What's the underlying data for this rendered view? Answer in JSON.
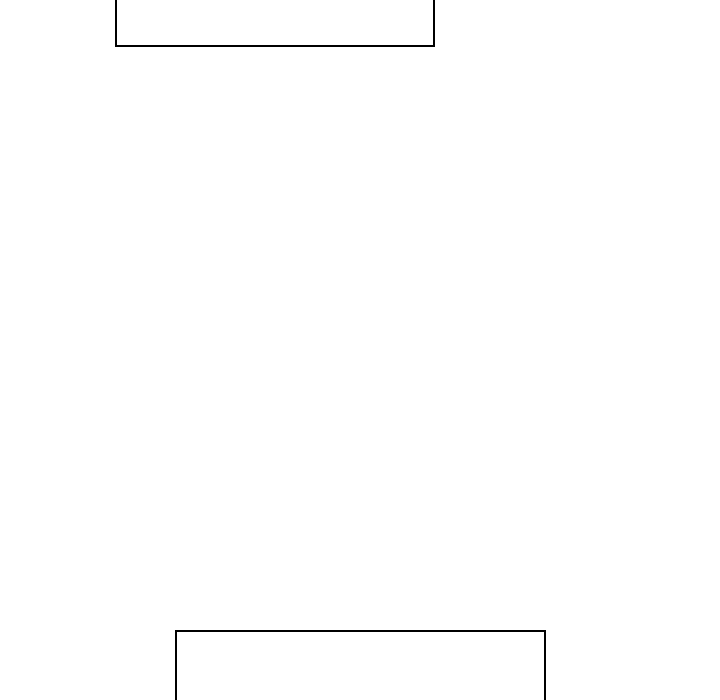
{
  "canvas": {
    "background_color": "#ffffff",
    "width_px": 720,
    "height_px": 700
  },
  "panels": [
    {
      "id": "top-panel",
      "description": "empty rectangular box clipped by the top edge of the screen",
      "border_color": "#000000",
      "fill_color": "#ffffff",
      "content": ""
    },
    {
      "id": "bottom-panel",
      "description": "empty rectangular box clipped by the bottom edge of the screen",
      "border_color": "#000000",
      "fill_color": "#ffffff",
      "content": ""
    }
  ]
}
